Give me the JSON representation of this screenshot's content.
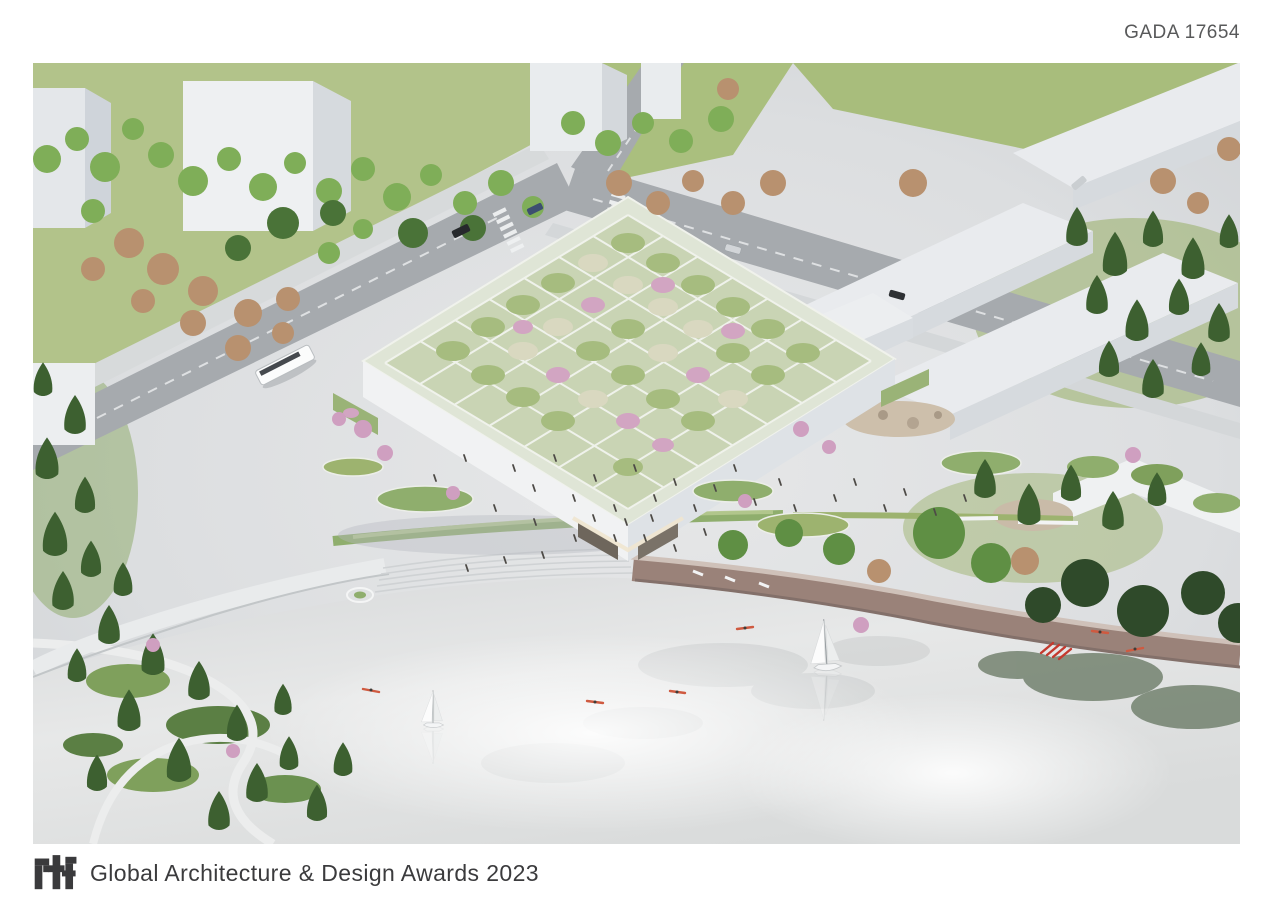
{
  "header": {
    "submission_id": "GADA 17654"
  },
  "footer": {
    "logo_text": "rtf",
    "award_title": "Global Architecture & Design Awards 2023"
  },
  "image": {
    "alt": "Aerial architectural rendering of a square cultural building with a terraced green roof of gridded gardens in green, cream and pink, set on a paved plaza between tree-lined streets, white warehouse blocks, a pine park with winding paths, and a reflective lake with sailboats, rowing kayaks and a curved brown waterfront boardwalk",
    "colors": {
      "page_background": "#ffffff",
      "header_text": "#58595a",
      "footer_text": "#3b3b3d",
      "logo_dark": "#3a3a3c",
      "plaza": "#dcdee0",
      "road_asphalt": "#a6aaae",
      "building_white": "#eef0f2",
      "roof_garden_green": "#a6bc7f",
      "roof_garden_pale": "#d9d8c0",
      "bloom_pink": "#d2a5c2",
      "tree_green": "#4e7c3c",
      "tree_pine": "#3d6030",
      "tree_autumn": "#b8916f",
      "grass": "#aabf7e",
      "water": "#e2e4e5",
      "boardwalk_brown": "#9a8279",
      "kayak_red": "#cf5a40"
    }
  }
}
